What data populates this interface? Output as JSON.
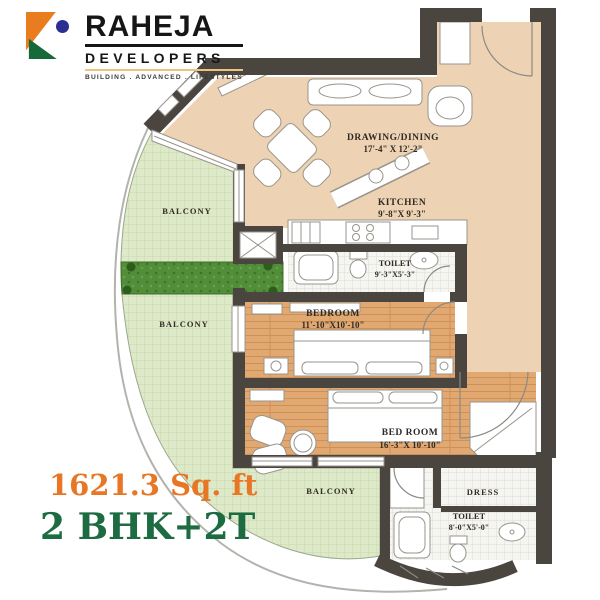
{
  "logo": {
    "brand": "RAHEJA",
    "sub": "DEVELOPERS",
    "tagline": "BUILDING . ADVANCED . LIFESTYLES"
  },
  "summary": {
    "area": "1621.3 Sq. ft",
    "type": "2 BHK+2T",
    "area_color": "#e87725",
    "type_color": "#1c6b41"
  },
  "plan": {
    "rooms": {
      "drawing": {
        "label": "DRAWING/DINING",
        "dims": "17'-4\" X 12'-2\""
      },
      "kitchen": {
        "label": "KITCHEN",
        "dims": "9'-8\"X 9'-3\""
      },
      "toilet1": {
        "label": "TOILET",
        "dims": "9'-3\"X5'-3\""
      },
      "bedroom1": {
        "label": "BEDROOM",
        "dims": "11'-10\"X10'-10\""
      },
      "bedroom2": {
        "label": "BED ROOM",
        "dims": "16'-3\"X 10'-10\""
      },
      "dress": {
        "label": "DRESS"
      },
      "toilet2": {
        "label": "TOILET",
        "dims": "8'-0\"X5'-0\""
      },
      "balcony_top": {
        "label": "BALCONY"
      },
      "balcony_mid": {
        "label": "BALCONY"
      },
      "balcony_bottom": {
        "label": "BALCONY"
      }
    },
    "colors": {
      "wall": "#4a453e",
      "living_floor": "#edd3b4",
      "wood_floor": "#e2a871",
      "balcony": "#dde9c9",
      "planter": "#528e39",
      "tile": "#f5f5f1"
    }
  }
}
